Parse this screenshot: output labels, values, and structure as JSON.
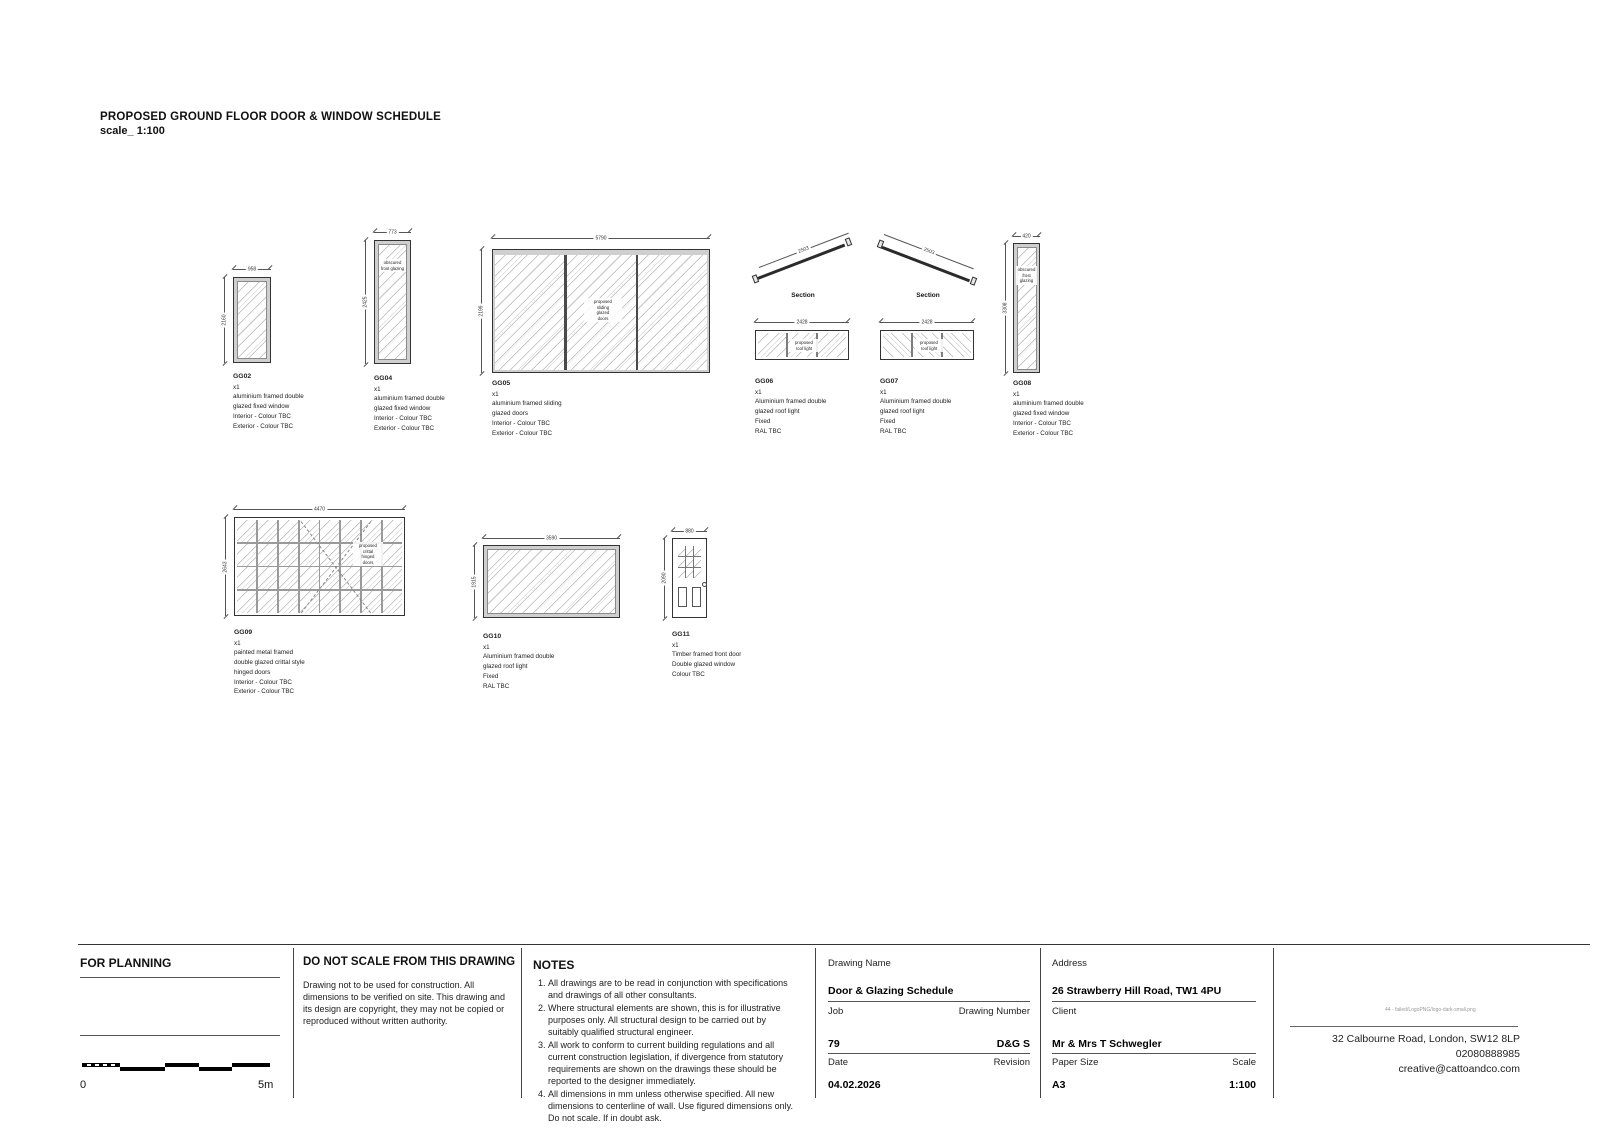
{
  "sheet": {
    "title": "PROPOSED GROUND FLOOR DOOR & WINDOW SCHEDULE",
    "scale_line": "scale_ 1:100"
  },
  "items": {
    "gg02": {
      "id": "GG02",
      "qty": "x1",
      "dim_w": "958",
      "dim_h": "2160",
      "spec": [
        "aluminium framed double",
        "glazed fixed window",
        "Interior - Colour TBC",
        "Exterior - Colour TBC"
      ]
    },
    "gg04": {
      "id": "GG04",
      "qty": "x1",
      "dim_w": "773",
      "dim_h": "2425",
      "note": [
        "obscured",
        "frost glazing"
      ],
      "spec": [
        "aluminium framed double",
        "glazed fixed window",
        "Interior - Colour TBC",
        "Exterior - Colour TBC"
      ]
    },
    "gg05": {
      "id": "GG05",
      "qty": "x1",
      "dim_w": "5790",
      "dim_h": "2199",
      "note": [
        "proposed",
        "sliding",
        "glazed",
        "doors"
      ],
      "spec": [
        "aluminium framed sliding",
        "glazed doors",
        "Interior - Colour TBC",
        "Exterior - Colour TBC"
      ]
    },
    "gg06": {
      "id": "GG06",
      "qty": "x1",
      "section_label": "Section",
      "dim_slope": "2503",
      "dim_w": "2428",
      "note": [
        "proposed",
        "roof light"
      ],
      "spec": [
        "Aluminium framed double",
        "glazed roof light",
        "Fixed",
        "RAL TBC"
      ]
    },
    "gg07": {
      "id": "GG07",
      "qty": "x1",
      "section_label": "Section",
      "dim_slope": "2503",
      "dim_w": "2428",
      "note": [
        "proposed",
        "roof light"
      ],
      "spec": [
        "Aluminium framed double",
        "glazed roof light",
        "Fixed",
        "RAL TBC"
      ]
    },
    "gg08": {
      "id": "GG08",
      "qty": "x1",
      "dim_w": "420",
      "dim_h": "3308",
      "note": [
        "obscured",
        "frost",
        "glazing"
      ],
      "spec": [
        "aluminium framed double",
        "glazed fixed window",
        "Interior - Colour TBC",
        "Exterior - Colour TBC"
      ]
    },
    "gg09": {
      "id": "GG09",
      "qty": "x1",
      "dim_w": "4470",
      "dim_h": "2643",
      "note": [
        "proposed",
        "crittal",
        "hinged",
        "doors"
      ],
      "spec": [
        "painted metal framed",
        "double glazed crittal style",
        "hinged doors",
        "Interior - Colour TBC",
        "Exterior - Colour TBC"
      ]
    },
    "gg10": {
      "id": "GG10",
      "qty": "x1",
      "dim_w": "3590",
      "dim_h": "1915",
      "spec": [
        "Aluminium framed double",
        "glazed roof light",
        "Fixed",
        "RAL TBC"
      ]
    },
    "gg11": {
      "id": "GG11",
      "qty": "x1",
      "dim_w": "880",
      "dim_h": "2090",
      "spec": [
        "Timber framed front door",
        "Double glazed window",
        "Colour TBC"
      ]
    }
  },
  "titleblock": {
    "for_planning": "FOR PLANNING",
    "scalebar": {
      "zero": "0",
      "end": "5m"
    },
    "do_not_scale": {
      "heading": "DO NOT SCALE FROM THIS DRAWING",
      "body": "Drawing not to be used for construction. All dimensions to be verified on site. This drawing and its design are copyright, they may not be copied or reproduced without written authority."
    },
    "notes": {
      "heading": "NOTES",
      "items": [
        "All drawings are to be read in conjunction with specifications and drawings of all other consultants.",
        "Where structural elements are shown, this is for illustrative purposes only. All structural design to be carried out by suitably qualified structural engineer.",
        "All work to conform to current building regulations and all current construction legislation, if divergence from statutory requirements are shown on the drawings these should be reported to the designer immediately.",
        "All dimensions in mm unless otherwise specified. All new dimensions to centerline of wall. Use figured dimensions only. Do not scale. If in doubt ask."
      ]
    },
    "drawing": {
      "name_label": "Drawing Name",
      "name": "Door & Glazing Schedule",
      "job_label": "Job",
      "job": "79",
      "number_label": "Drawing Number",
      "number": "D&G S",
      "date_label": "Date",
      "date": "04.02.2026",
      "revision_label": "Revision",
      "revision": ""
    },
    "project": {
      "address_label": "Address",
      "address": "26 Strawberry Hill Road, TW1 4PU",
      "client_label": "Client",
      "client": "Mr & Mrs T Schwegler",
      "paper_label": "Paper Size",
      "paper": "A3",
      "scale_label": "Scale",
      "scale": "1:100"
    },
    "studio": {
      "logo_alt": "44 - failed/LogoPNG/logo-dark-small.png",
      "address": "32 Calbourne Road, London, SW12 8LP",
      "phone": "02080888985",
      "email": "creative@cattoandco.com"
    }
  }
}
